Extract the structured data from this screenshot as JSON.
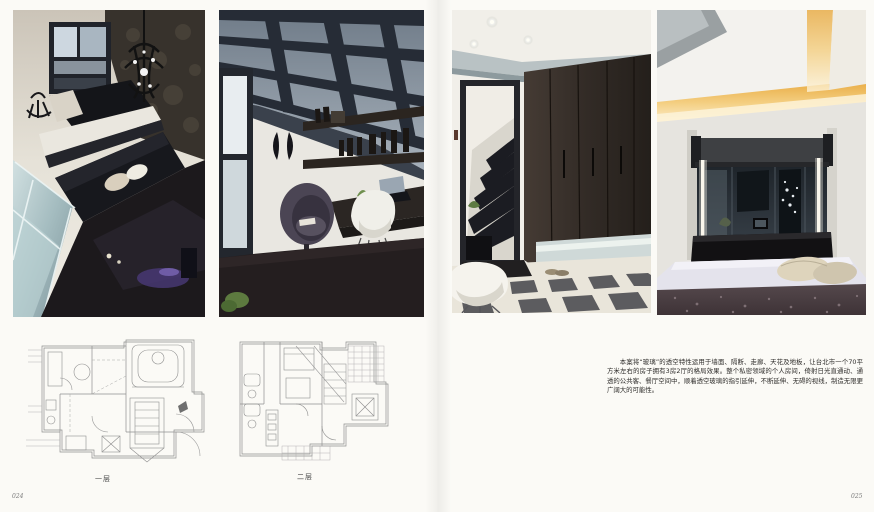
{
  "page": {
    "background_color": "#fbfaf6",
    "left_page_number": "024",
    "right_page_number": "025"
  },
  "floor_plans": {
    "plan_one_caption": "一层",
    "plan_two_caption": "二层",
    "line_color": "#8f8f8f"
  },
  "article": {
    "paragraph": "本案将“玻璃”的透空特性运用于墙面、隔断、走廊、天花及地板，让台北市一个70平方米左右的房子拥有3房2厅的格局效果。整个私密领域的个人房间，倚射日光直通动、通透的公共客、餐厅空间中，顺着透空玻璃的指引延伸，不断延伸、无碍的视线，制造无限更广阔大的可能性。"
  },
  "photos": {
    "loft_label": "loft living room with glass floor and chandelier",
    "study_label": "study room with glass beam ceiling",
    "hallway_label": "hallway with dark wardrobe and checkered floor",
    "bedroom_label": "bedroom with glass partition and cove lighting"
  },
  "colors": {
    "dark_wood": "#2e2825",
    "glass_blue": "#9aa7b1",
    "warm_cove": "#f0c368",
    "sofa_black": "#17181d"
  }
}
